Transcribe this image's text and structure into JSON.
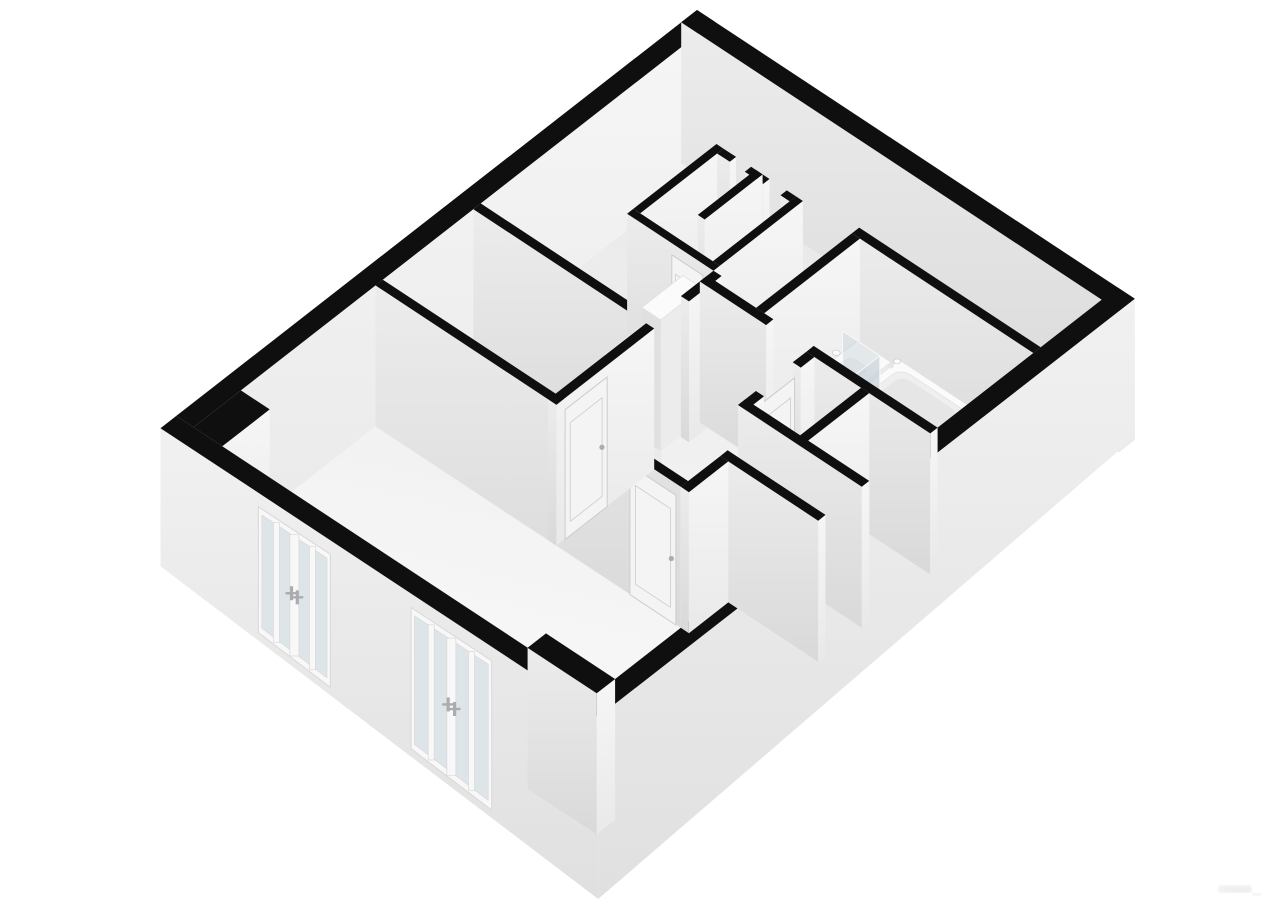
{
  "scene": {
    "title": "3D floor plan rendering of an apartment",
    "type": "isometric-floorplan-render",
    "background": "#ffffff"
  },
  "palette": {
    "background": "#ffffff",
    "wall_cap": "#0f0f0f",
    "face_lit_top": "#f6f6f6",
    "face_lit_bottom": "#e9e9e9",
    "face_shade_top": "#ececec",
    "face_shade_bottom": "#d9d9d9",
    "floor_far": "#e7e7e7",
    "floor_near": "#fafafa",
    "facade_top": "#f1f1f1",
    "facade_bottom": "#e0e0e0",
    "window_glass": "#dee5e9",
    "window_frame": "#f8f8f8",
    "window_frame_line": "#d8d8d8",
    "shower_glass": "rgba(198,209,214,0.45)",
    "shower_glass_edge": "rgba(244,247,248,0.95)",
    "fixture_top": "#fbfbfb",
    "fixture_side": "#ececec",
    "fixture_side_dark": "#e0e0e0",
    "fixture_line": "#e2e2e2",
    "door_leaf": "#f4f4f4",
    "door_line": "#cccccc",
    "handle": "#a9adaf",
    "basin": "#efefef",
    "basin_shadow": "#e6e6e6",
    "closet_shade": "rgba(0,0,0,0.05)"
  },
  "elements": [
    "perimeter-walls-black-cap",
    "interior-partition-walls",
    "closet-core-two-closets",
    "kitchen-cabinet-tall",
    "kitchen-counter",
    "small-cabinet",
    "bathtub",
    "vanity-two-sinks",
    "shower-glass-panel",
    "shower-drain",
    "toilet",
    "bedroom-door-leaf",
    "living-room-door-leaf",
    "closet-door-leaf",
    "wc-door-leaf",
    "french-window-group-1",
    "french-window-group-2",
    "wall-pier-west-corner",
    "wall-pier-south-corner"
  ],
  "watermark": {
    "present": true,
    "legible": false
  }
}
